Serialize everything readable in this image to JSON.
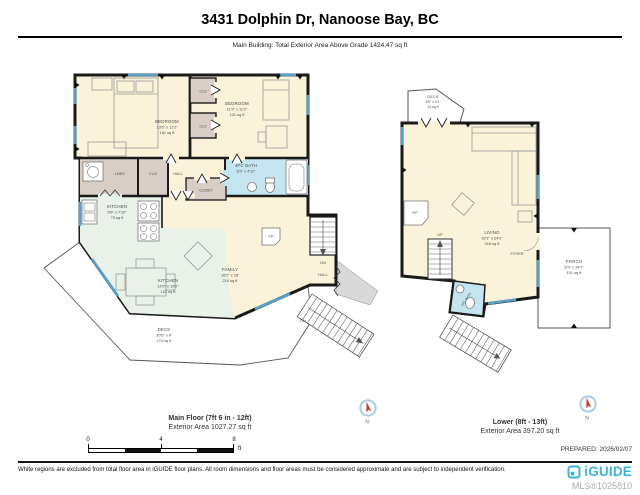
{
  "header": {
    "title": "3431 Dolphin Dr, Nanoose Bay, BC",
    "subtitle": "Main Building: Total Exterior Area Above Grade 1424.47 sq ft"
  },
  "main_floor": {
    "caption_line1": "Main Floor (7ft 6 in - 12ft)",
    "caption_line2": "Exterior Area 1027.27 sq ft",
    "rooms": {
      "bedroom1": {
        "name": "BEDROOM",
        "dims": "13'6\" x 11'2\"",
        "area": "151 sq ft"
      },
      "bedroom2": {
        "name": "BEDROOM",
        "dims": "11'9\" x 11'2\"",
        "area": "131 sq ft"
      },
      "kitchen": {
        "name": "KITCHEN",
        "dims": "9'6\" x 7'10\"",
        "area": "73 sq ft"
      },
      "nook": {
        "name": "KITCHEN",
        "dims": "12'0\" x 10'2\"",
        "area": "121 sq ft"
      },
      "family": {
        "name": "FAMILY",
        "dims": "16'2\" x 16'",
        "area": "214 sq ft"
      },
      "bath": {
        "name": "4PC BATH",
        "dims": "8'2\" x 4'11\""
      },
      "deck": {
        "name": "DECK",
        "dims": "30'5\" x 9'",
        "area": "274 sq ft"
      },
      "laundry": {
        "name": "LNDY"
      },
      "closet_hall": {
        "name": "CLO"
      },
      "closet_bed1": {
        "name": "CLO"
      },
      "closet_bed2": {
        "name": "CLO"
      },
      "hall": {
        "name": "HALL"
      },
      "closet": {
        "name": "CLOSET"
      },
      "hall_lower": {
        "name": "HALL"
      },
      "fireplace": {
        "name": "F/P"
      },
      "stairs_down": {
        "name": "DN"
      },
      "stairs_exterior": {
        "name": "DN"
      }
    }
  },
  "lower_floor": {
    "caption_line1": "Lower (8ft - 13ft)",
    "caption_line2": "Exterior Area 397.20 sq ft",
    "rooms": {
      "deck": {
        "name": "DECK",
        "dims": "6'5\" x 4'1\"",
        "area": "24 sq ft"
      },
      "living": {
        "name": "LIVING",
        "dims": "16'1\" x 24'2\"",
        "area": "316 sq ft"
      },
      "foyer": {
        "name": "FOYER"
      },
      "bath": {
        "name": "2PC BATH"
      },
      "porch": {
        "name": "PORCH",
        "dims": "8'9\" x 14'7\"",
        "area": "101 sq ft"
      },
      "stairs_up": {
        "name": "UP"
      },
      "fireplace": {
        "name": "F/P"
      }
    }
  },
  "compass": {
    "label": "N"
  },
  "scale_bar": {
    "tick0": "0",
    "tick4": "4",
    "tick8": "8",
    "unit": "ft"
  },
  "footer": {
    "prepared": "PREPARED: 2026/02/07",
    "disclaimer": "White regions are excluded from total floor area in iGUIDE floor plans. All room dimensions and floor areas must be considered approximate and are subject to independent verification.",
    "brand": "iGUIDE",
    "mls": "MLS®1025810"
  },
  "colors": {
    "wall": "#1A1A1A",
    "room_fill": "#FAF3DA",
    "closet_fill": "#D8CEC5",
    "bath_fill": "#C4E5F0",
    "kitchen_fill": "#E8F2E9",
    "window": "#5D9FC4",
    "excluded": "#D9D9D9",
    "brand": "#3FB3D6",
    "compass_needle": "#C23B3B"
  }
}
